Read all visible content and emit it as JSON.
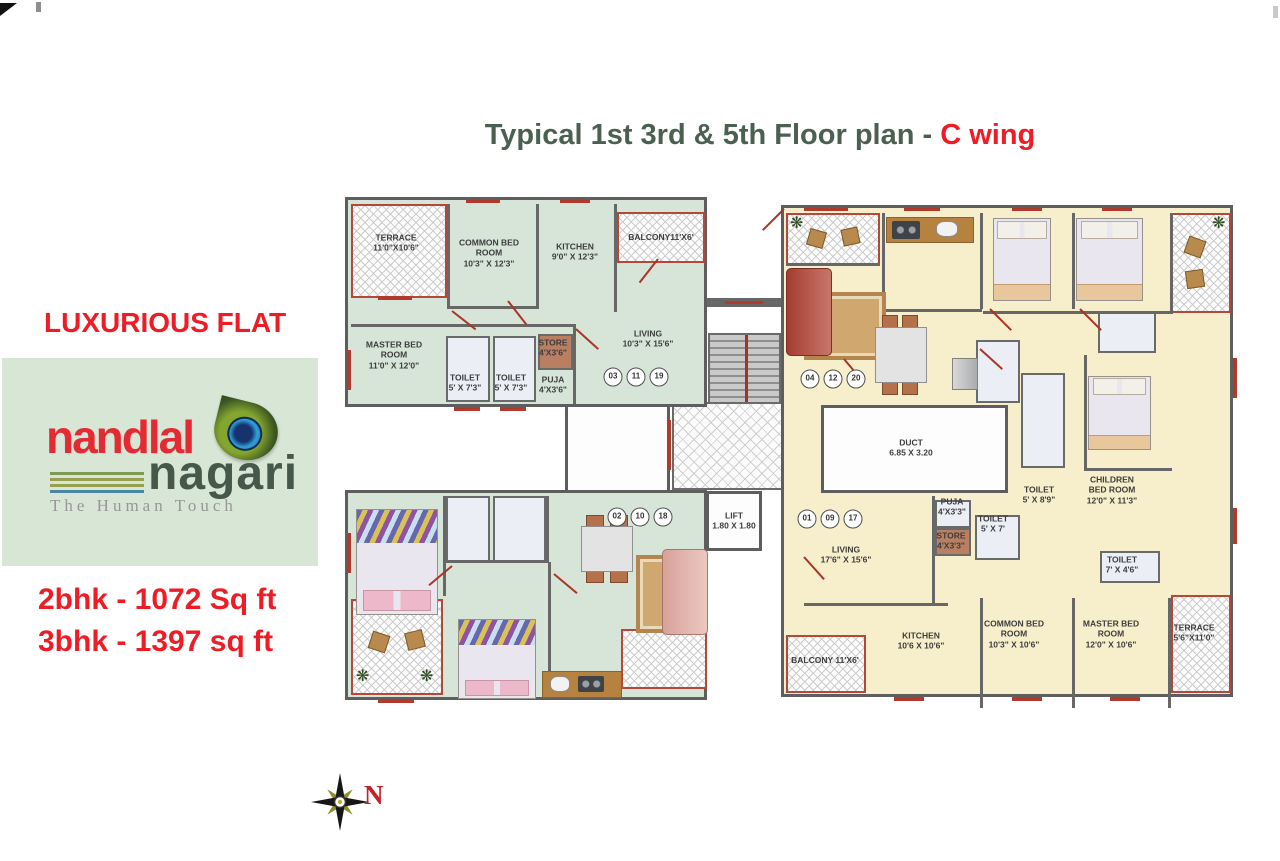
{
  "title": {
    "main": "Typical 1st 3rd & 5th Floor plan - ",
    "wing": "C wing"
  },
  "sidebar": {
    "tagline": "LUXURIOUS FLAT",
    "logo": {
      "name_top": "nandlal",
      "name_bottom": "nagari",
      "sub": "The Human Touch"
    },
    "area_2bhk": "2bhk - 1072 Sq ft",
    "area_3bhk": "3bhk - 1397 sq ft",
    "compass": "N"
  },
  "plan": {
    "core": {
      "lift_name": "LIFT",
      "lift_dim": "1.80 X 1.80",
      "duct_name": "DUCT",
      "duct_dim": "6.85 X 3.20"
    },
    "unit_2bhk": {
      "rooms": {
        "terrace": {
          "name": "TERRACE",
          "dim": "11'0\"X10'6\""
        },
        "common": {
          "name": "COMMON BED ROOM",
          "dim": "10'3\" X 12'3\""
        },
        "kitchen": {
          "name": "KITCHEN",
          "dim": "9'0\" X 12'3\""
        },
        "balcony": {
          "name": "BALCONY11'X6'",
          "dim": ""
        },
        "master": {
          "name": "MASTER BED ROOM",
          "dim": "11'0\" X 12'0\""
        },
        "toilet1": {
          "name": "TOILET",
          "dim": "5' X 7'3\""
        },
        "toilet2": {
          "name": "TOILET",
          "dim": "5' X 7'3\""
        },
        "store": {
          "name": "STORE",
          "dim": "4'X3'6\""
        },
        "puja": {
          "name": "PUJA",
          "dim": "4'X3'6\""
        },
        "living": {
          "name": "LIVING",
          "dim": "10'3\" X 15'6\""
        }
      },
      "flats": [
        "03",
        "11",
        "19"
      ]
    },
    "unit_3bhk": {
      "rooms": {
        "living": {
          "name": "LIVING",
          "dim": "17'6\" X 15'6\""
        },
        "puja": {
          "name": "PUJA",
          "dim": "4'X3'3\""
        },
        "store": {
          "name": "STORE",
          "dim": "4'X3'3\""
        },
        "toilet1": {
          "name": "TOILET",
          "dim": "5' X 7'"
        },
        "toilet2": {
          "name": "TOILET",
          "dim": "5' X 8'9\""
        },
        "children": {
          "name": "CHILDREN BED ROOM",
          "dim": "12'0\" X 11'3\""
        },
        "toilet3": {
          "name": "TOILET",
          "dim": "7' X 4'6\""
        },
        "kitchen": {
          "name": "KITCHEN",
          "dim": "10'6 X 10'6\""
        },
        "common": {
          "name": "COMMON BED ROOM",
          "dim": "10'3\" X 10'6\""
        },
        "master": {
          "name": "MASTER BED ROOM",
          "dim": "12'0\" X 10'6\""
        },
        "terrace": {
          "name": "TERRACE",
          "dim": "5'6\"X11'0\""
        },
        "balcony": {
          "name": "BALCONY 11'X6'",
          "dim": ""
        }
      },
      "flats": [
        "01",
        "09",
        "17"
      ]
    },
    "flats_top_right": [
      "04",
      "12",
      "20"
    ],
    "flats_bottom_left": [
      "02",
      "10",
      "18"
    ]
  },
  "colors": {
    "accent_red": "#ee1c25",
    "title_green": "#4c6052",
    "floor_green": "#d6e5d8",
    "floor_cream": "#f7eecb",
    "wall": "#5e5e5e",
    "window_red": "#b23a2c",
    "counter_brown": "#b5823f"
  }
}
